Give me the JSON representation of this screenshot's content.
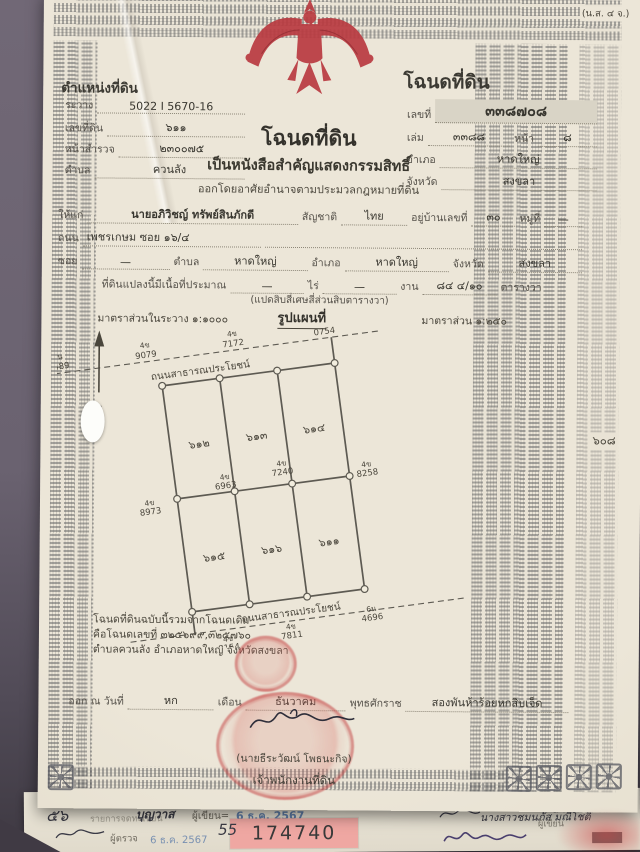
{
  "form_code": "(น.ส. ๔ จ.)",
  "position_block": {
    "title": "ตำแหน่งที่ดิน",
    "ravang_label": "ระวาง",
    "ravang": "5022 I 5670-16",
    "parcel_label": "เลขที่ดิน",
    "parcel": "๖๑๑",
    "survey_label": "หน้าสำรวจ",
    "survey": "๒๓๐๐๗๕",
    "tambon_label": "ตำบล",
    "tambon": "ควนลัง"
  },
  "deed_block": {
    "title": "โฉนดที่ดิน",
    "number_label": "เลขที่",
    "number": "๓๓๘๗๐๘",
    "volume_label": "เล่ม",
    "volume": "๓๓๘๘",
    "page_label": "หน้า",
    "page": "๘",
    "amphoe_label": "อำเภอ",
    "amphoe": "หาดใหญ่",
    "province_label": "จังหวัด",
    "province": "สงขลา"
  },
  "title_block": {
    "main": "โฉนดที่ดิน",
    "sub1": "เป็นหนังสือสำคัญแสดงกรรมสิทธิ์",
    "sub2": "ออกโดยอาศัยอำนาจตามประมวลกฎหมายที่ดิน"
  },
  "owner": {
    "given_label": "ให้แก่",
    "name": "นายอภิวิชญ์ ทรัพย์สินภักดี",
    "nationality_label": "สัญชาติ",
    "nationality": "ไทย",
    "house_no_label": "อยู่บ้านเลขที่",
    "house_no": "๓๐",
    "moo_label": "หมู่ที่",
    "moo": "—",
    "road_label": "ถนน",
    "road": "เพชรเกษม ซอย ๑๖/๔",
    "soi_label": "ซอย",
    "soi": "—",
    "tambon_label": "ตำบล",
    "tambon": "หาดใหญ่",
    "amphoe_label": "อำเภอ",
    "amphoe": "หาดใหญ่",
    "province_label": "จังหวัด",
    "province": "สงขลา"
  },
  "area": {
    "label": "ที่ดินแปลงนี้มีเนื้อที่ประมาณ",
    "rai": "—",
    "rai_label": "ไร่",
    "ngan": "—",
    "ngan_label": "งาน",
    "wa": "๘๔ ๔/๑๐",
    "wa_label": "ตารางวา",
    "in_words": "(แปดสิบสี่เศษสี่ส่วนสิบตารางวา)",
    "scale_sheet": "มาตราส่วนในระวาง ๑:๑๐๐๐",
    "map_title": "รูปแผนที่",
    "scale_map": "มาตราส่วน ๑:๒๕๐"
  },
  "map": {
    "road_top": "ถนนสาธารณประโยชน์",
    "road_bottom": "ถนนสาธารณประโยชน์",
    "north_label": "น",
    "neighbor_right": "๖๐๘",
    "plots_top": [
      "๖๑๒",
      "๖๑๓",
      "๖๑๔"
    ],
    "plots_bottom": [
      "๖๑๕",
      "๖๑๖",
      "๖๑๑"
    ],
    "markers_top": [
      {
        "prefix": "6น",
        "number": "2489"
      },
      {
        "prefix": "4ข",
        "number": "9079"
      },
      {
        "prefix": "4ข",
        "number": "7172"
      },
      {
        "prefix": "6น",
        "number": "0754"
      }
    ],
    "markers_middle": [
      {
        "prefix": "4ข",
        "number": "8973"
      },
      {
        "prefix": "4ข",
        "number": "6963"
      },
      {
        "prefix": "4ข",
        "number": "7240"
      },
      {
        "prefix": "4ข",
        "number": "8258"
      }
    ],
    "markers_bottom": [
      {
        "prefix": "4ข",
        "number": "8154"
      },
      {
        "prefix": "4ข",
        "number": "7811"
      },
      {
        "prefix": "6น",
        "number": "4696"
      }
    ]
  },
  "origin_note": {
    "line1": "โฉนดที่ดินฉบับนี้รวมจากโฉนดเดิม",
    "line2": "คือโฉนดเลขที่ ๓๒๕๖๙๙,๓๒๕๗๖๐",
    "line3": "ตำบลควนลัง อำเภอหาดใหญ่ จังหวัดสงขลา"
  },
  "issue": {
    "date_label": "ออก ณ วันที่",
    "day": "หก",
    "month_label": "เดือน",
    "month": "ธันวาคม",
    "era_label": "พุทธศักราช",
    "year": "สองพันห้าร้อยหกสิบเจ็ด",
    "signer_name": "(นายธีระวัฒน์ โพธนะกิจ)",
    "signer_title": "เจ้าพนักงานที่ดิน"
  },
  "strip": {
    "corner_number": "๕๖",
    "faint_label": "รายการจดทะเบียน",
    "writer_name": "บุญวาส",
    "writer_label": "ผู้เขียน",
    "writer_date": "6 ธ.ค. 2567",
    "checker_label": "ผู้ตรวจ",
    "checker_date": "6 ธ.ค. 2567",
    "doc_number_prefix": "55",
    "doc_number": "174740",
    "right_name": "นางสาวชมนภัส มณีโชติ",
    "right_date": "๕ พ.ย. ๒๕๖๗",
    "right_label": "ผู้เขียน"
  },
  "colors": {
    "paper": "#eae4d6",
    "garuda_red": "#b93a41",
    "seal_red": "#c13e3e",
    "highlight_pink": "#efa7a2",
    "stamp_blue": "#4a6fa5"
  }
}
